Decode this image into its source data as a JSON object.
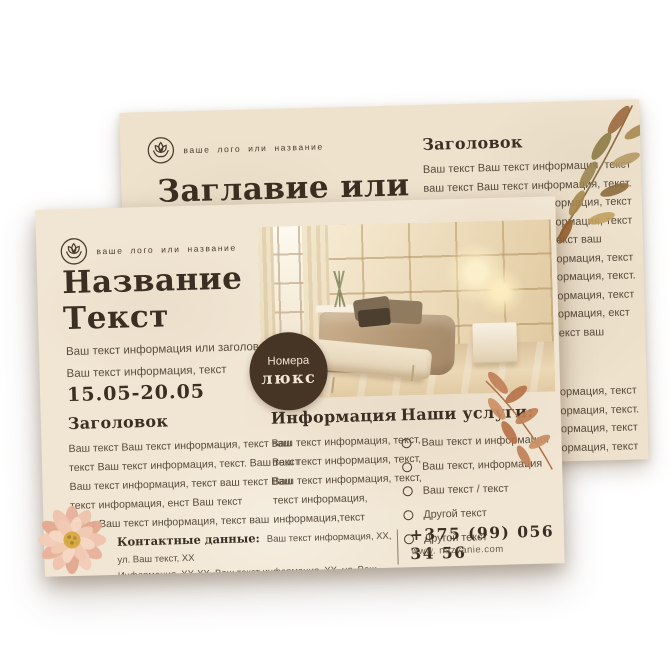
{
  "colors": {
    "background": "#ffffff",
    "paper_front": "#f1e6d3",
    "paper_back": "#eee2cd",
    "heading_text": "#3b2f23",
    "body_text": "#584b3c",
    "badge_bg": "#463425",
    "badge_text": "#f3e8d4",
    "leaf_olive": "#9b8450",
    "leaf_terracotta": "#c08156",
    "flower_pink": "#eab9a4"
  },
  "icons": {
    "logo": "lotus-flower-in-circle",
    "back_decor": "watercolor-leaf-branch",
    "front_decor": "terracotta-leaf-branch",
    "corner_decor": "watercolor-dahlia-flower",
    "list_bullet": "circle-outline"
  },
  "back_flyer": {
    "logo_text": "ваше лого или название",
    "title": "Заглавие или",
    "column": {
      "heading": "Заголовок",
      "para1": [
        "Ваш текст Ваш текст информация, текст",
        "ваш текст Ваш текст информация, текст.",
        "Ваш текст Ваш текст информация, текст",
        "Ваш текст Ваш текст информация, текст",
        "Ваш текст информация, текст ваш",
        "Ваш текст Ваш текст информация, текст",
        "Ваш текст Ваш текст информация, текст.",
        "Ваш текст Ваш текст информация, текст",
        "Ваш текст Ваш текст информация, екст",
        "Ваш текст информация, текст ваш"
      ],
      "para2": [
        "Ваш текст Ваш текст информация, текст",
        "Ваш текст Ваш текст информация, текст.",
        "Ваш текст Ваш текст информация, текст",
        "Ваш текст Ваш текст информация, текст"
      ]
    }
  },
  "front_flyer": {
    "logo_text": "ваше лого или название",
    "title_line1": "Название",
    "title_line2": "Текст",
    "subtitle_line1": "Ваш текст информация или заголовок.",
    "subtitle_line2": "Ваш текст информация, текст",
    "dates": "15.05-20.05",
    "badge": {
      "line1": "Номера",
      "line2": "люкс"
    },
    "columns": {
      "c1": {
        "heading": "Заголовок",
        "lines": [
          "Ваш текст Ваш текст информация, текст ваш",
          "текст Ваш текст информация, текст. Ваш текст",
          "Ваш текст информация, текст ваш текст Ваш",
          "текст информация, енст Ваш текст",
          "текст Ваш текст информация, текст ваш"
        ]
      },
      "c2": {
        "heading": "Информация",
        "lines": [
          "Ваш текст информация, текст,",
          "Ваш текст информация, текст,",
          "Ваш текст информация, текст,",
          "текст информация,",
          "информация,текст"
        ]
      },
      "c3": {
        "heading": "Наши услуги:",
        "items": [
          "Ваш текст и информация",
          "Ваш текст, информация",
          "Ваш текст / текст",
          "Другой текст",
          "Другой текст"
        ]
      }
    },
    "contacts": {
      "label": "Контактные данные:",
      "line1": "Ваш текст информация, XX, ул. Ваш текст, XX",
      "line2": "Информация, XX-XX, Ваш текст информация, XX, ул. Ваш текст, XX,"
    },
    "phone": "+375 (99) 056 34 56",
    "website": "www. nazvanie.com"
  }
}
